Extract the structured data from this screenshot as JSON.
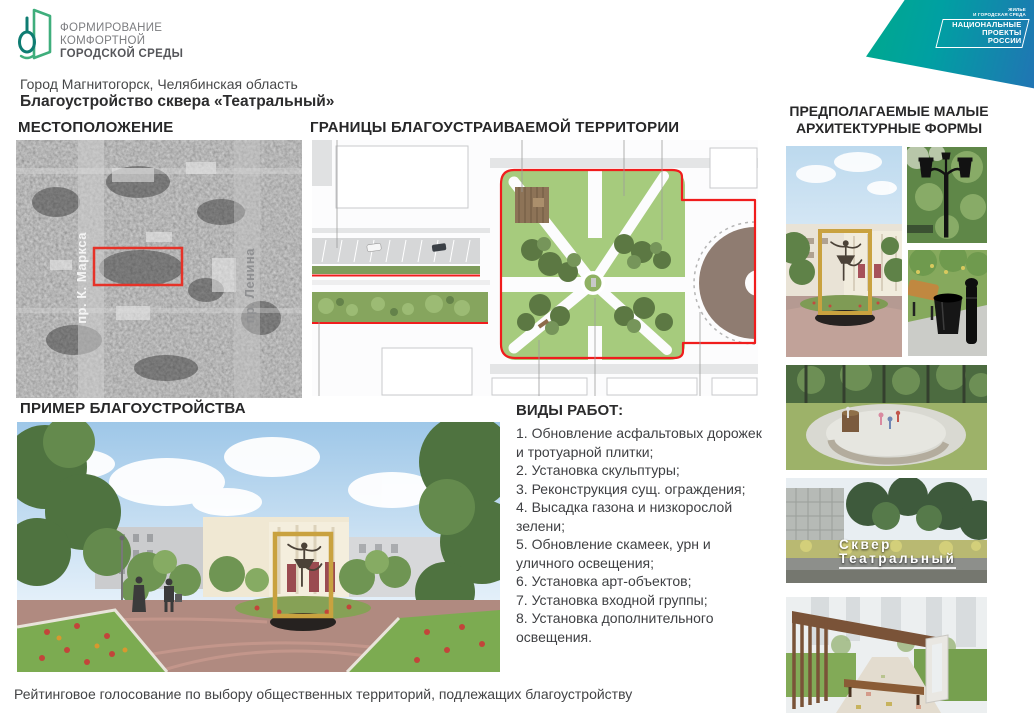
{
  "logo": {
    "line1": "ФОРМИРОВАНИЕ",
    "line2": "КОМФОРТНОЙ",
    "line3": "ГОРОДСКОЙ СРЕДЫ",
    "icon": "fkgs-leaf-book-icon",
    "green": "#3fae7c",
    "teal": "#0e7c72"
  },
  "banner": {
    "small_line1": "ЖИЛЬЕ",
    "small_line2": "И ГОРОДСКАЯ СРЕДА",
    "big_line1": "НАЦИОНАЛЬНЫЕ",
    "big_line2": "ПРОЕКТЫ",
    "big_line3": "РОССИИ",
    "gradient_start": "#00a98c",
    "gradient_end": "#2174b4"
  },
  "header": {
    "location": "Город Магнитогорск, Челябинская область",
    "title": "Благоустройство сквера «Театральный»"
  },
  "sections": {
    "location": {
      "title": "МЕСТОПОЛОЖЕНИЕ",
      "map_labels": [
        "пр. К. Маркса",
        "пр. Ленина"
      ],
      "map_type": "black-and-white-satellite-map",
      "boundary_color": "#e63228"
    },
    "boundaries": {
      "title": "ГРАНИЦЫ БЛАГОУСТРАИВАЕМОЙ ТЕРРИТОРИИ",
      "plan_boundary_color": "#f01d1d",
      "lawn_green": "#a6cb7d",
      "plaza_brown": "#8f7c71"
    },
    "maf": {
      "title_line1": "ПРЕДПОЛАГАЕМЫЕ МАЛЫЕ",
      "title_line2": "АРХИТЕКТУРНЫЕ ФОРМЫ",
      "photos": [
        "ballerina-sculpture-in-frame-photo",
        "park-lantern-photo",
        "bench-and-urn-photo",
        "round-bench-playground-render",
        "skver-teatralny-sign-photo",
        "wooden-pergola-bench-render"
      ]
    },
    "example": {
      "title": "ПРИМЕР БЛАГОУСТРОЙСТВА",
      "photo": "park-render-ballerina-sculpture-photo"
    },
    "works": {
      "title": "ВИДЫ РАБОТ:",
      "items": [
        "1. Обновление асфальтовых дорожек и тротуарной плитки;",
        "2. Установка скульптуры;",
        "3. Реконструкция сущ. ограждения;",
        "4. Высадка газона и низкорослой зелени;",
        "5. Обновление скамеек, урн и уличного освещения;",
        "6. Установка арт-объектов;",
        "7. Установка входной группы;",
        "8. Установка дополнительного освещения."
      ]
    }
  },
  "park_sign": {
    "line1": "Сквер",
    "line2": "Театральный"
  },
  "footer": {
    "text": "Рейтинговое голосование по выбору общественных территорий, подлежащих благоустройству"
  }
}
